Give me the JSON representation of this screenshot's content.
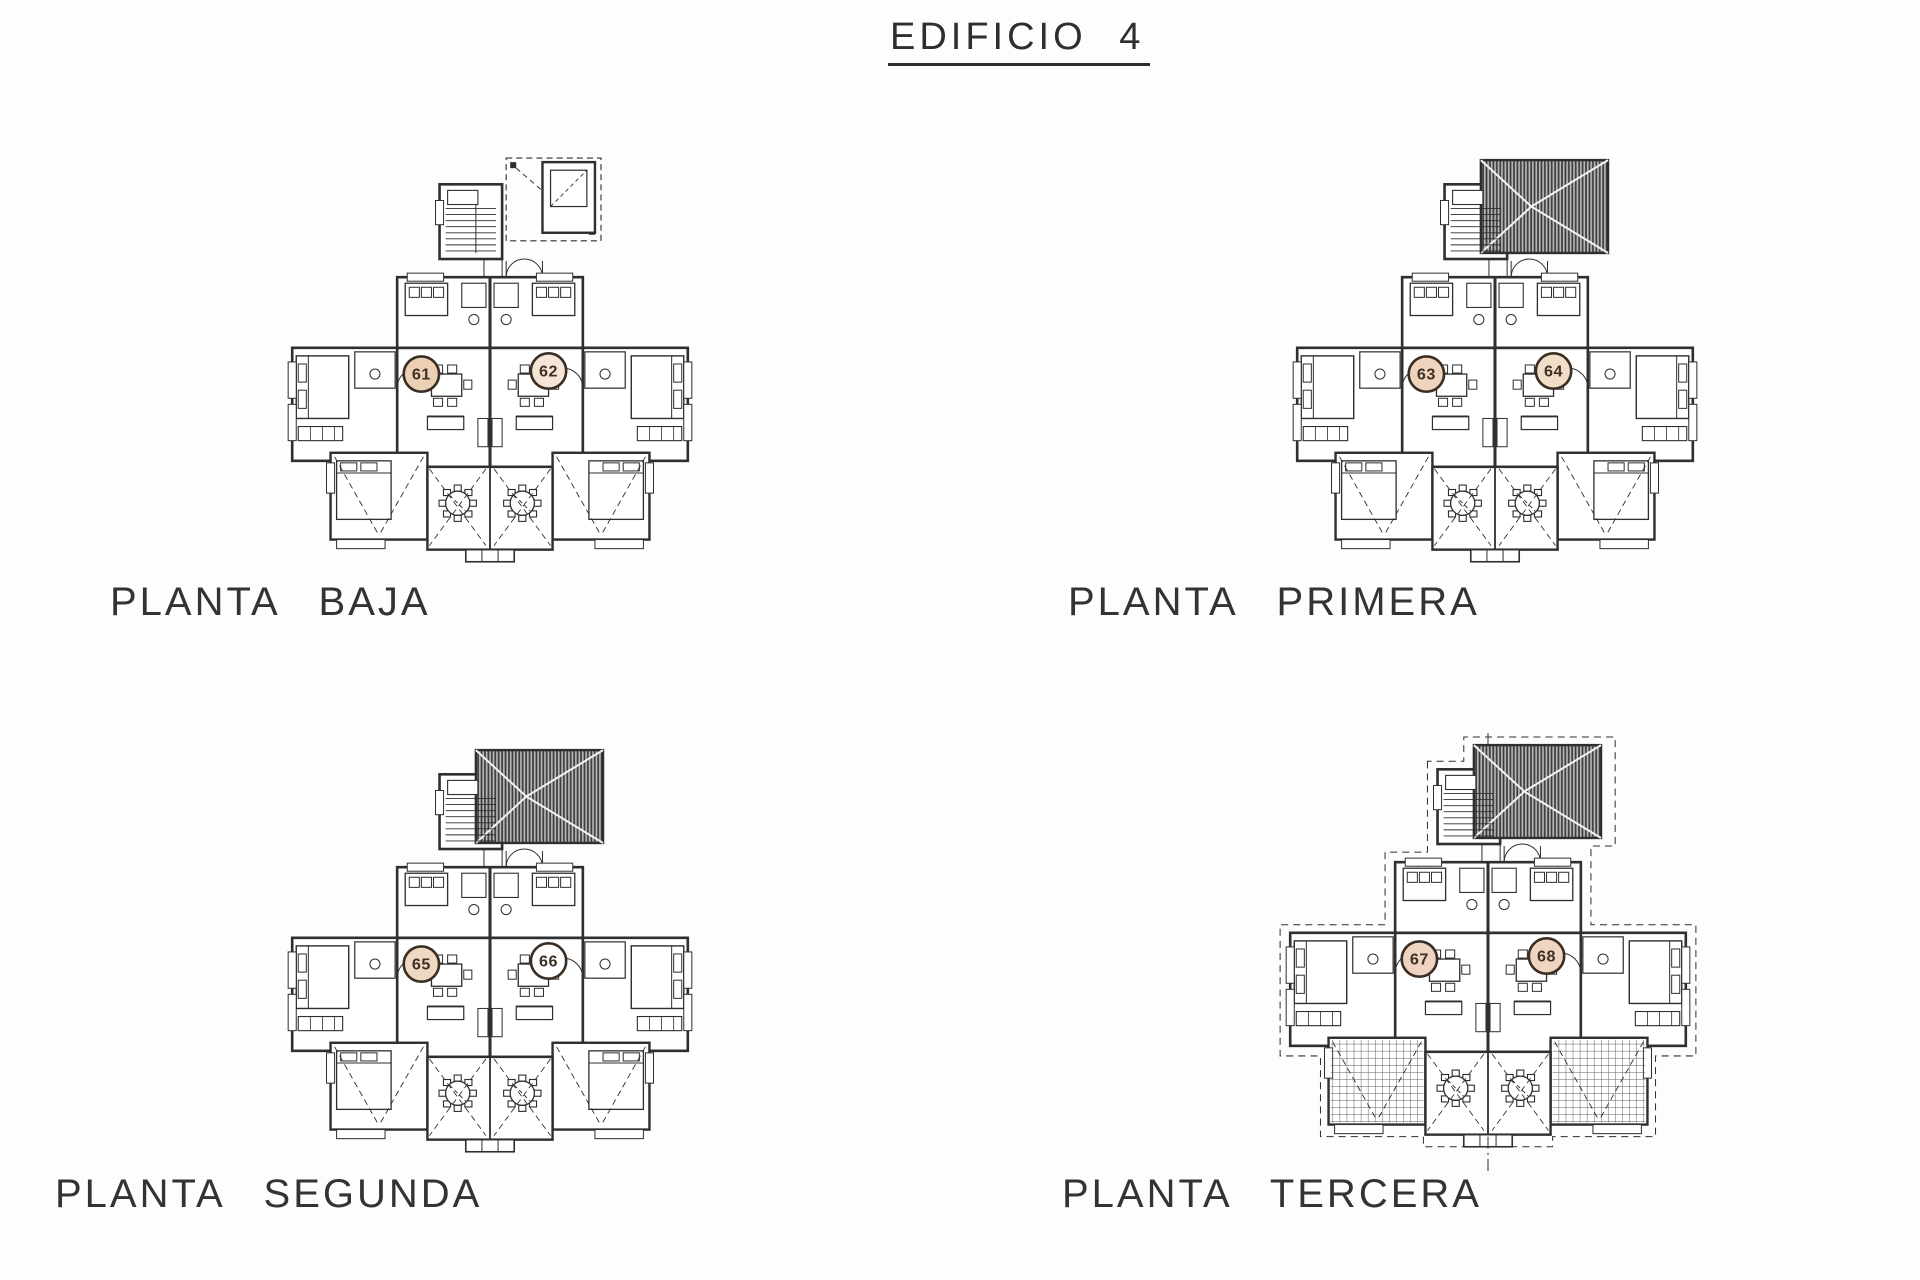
{
  "title": "EDIFICIO 4",
  "colors": {
    "ink": "#2f2f2f",
    "paper": "#ffffff",
    "unit_circle_stroke": "#3a2e24",
    "unit_number_ink": "#3d2f22",
    "roof_hatch": "#3a3a3a",
    "pergola_grid": "#555555"
  },
  "floors": [
    {
      "id": "baja",
      "label": "PLANTA BAJA",
      "variant": "dashed-porch",
      "units": [
        {
          "number": "61",
          "fill": "#ecd0b6"
        },
        {
          "number": "62",
          "fill": "#f4e5d6"
        }
      ]
    },
    {
      "id": "primera",
      "label": "PLANTA PRIMERA",
      "variant": "hatched-roof",
      "units": [
        {
          "number": "63",
          "fill": "#eed3bd"
        },
        {
          "number": "64",
          "fill": "#f2ddc9"
        }
      ]
    },
    {
      "id": "segunda",
      "label": "PLANTA SEGUNDA",
      "variant": "hatched-roof",
      "units": [
        {
          "number": "65",
          "fill": "#f0d9c2"
        },
        {
          "number": "66",
          "fill": "#ffffff"
        }
      ]
    },
    {
      "id": "tercera",
      "label": "PLANTA TERCERA",
      "variant": "hatched-roof-dashed",
      "units": [
        {
          "number": "67",
          "fill": "#eed3c0"
        },
        {
          "number": "68",
          "fill": "#edd5c2"
        }
      ]
    }
  ]
}
